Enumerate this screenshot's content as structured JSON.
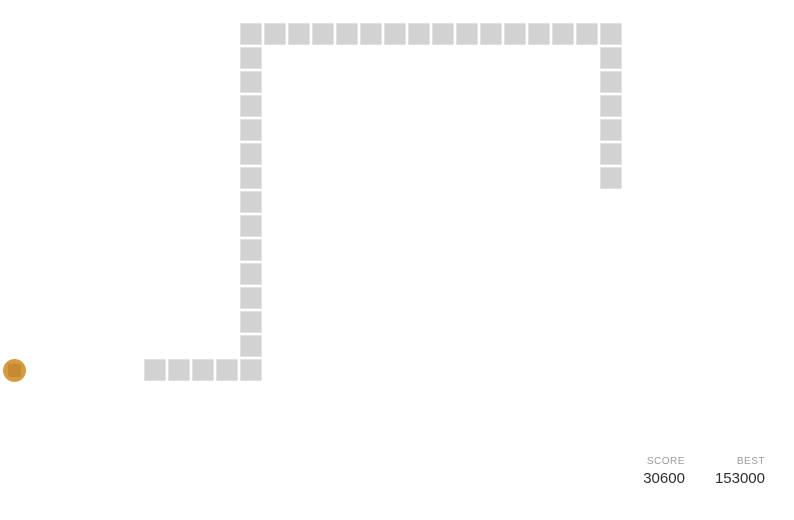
{
  "board": {
    "background": "#ffffff",
    "grid": {
      "cell_size": 24,
      "origin_x": -1,
      "origin_y": 22,
      "gap": 2
    },
    "snake": {
      "color": "#d2d2d2",
      "length": 40,
      "cells": [
        [
          6,
          14
        ],
        [
          7,
          14
        ],
        [
          8,
          14
        ],
        [
          9,
          14
        ],
        [
          10,
          14
        ],
        [
          10,
          13
        ],
        [
          10,
          12
        ],
        [
          10,
          11
        ],
        [
          10,
          10
        ],
        [
          10,
          9
        ],
        [
          10,
          8
        ],
        [
          10,
          7
        ],
        [
          10,
          6
        ],
        [
          10,
          5
        ],
        [
          10,
          4
        ],
        [
          10,
          3
        ],
        [
          10,
          2
        ],
        [
          10,
          1
        ],
        [
          10,
          0
        ],
        [
          11,
          0
        ],
        [
          12,
          0
        ],
        [
          13,
          0
        ],
        [
          14,
          0
        ],
        [
          15,
          0
        ],
        [
          16,
          0
        ],
        [
          17,
          0
        ],
        [
          18,
          0
        ],
        [
          19,
          0
        ],
        [
          20,
          0
        ],
        [
          21,
          0
        ],
        [
          22,
          0
        ],
        [
          23,
          0
        ],
        [
          24,
          0
        ],
        [
          25,
          0
        ],
        [
          25,
          1
        ],
        [
          25,
          2
        ],
        [
          25,
          3
        ],
        [
          25,
          4
        ],
        [
          25,
          5
        ],
        [
          25,
          6
        ]
      ]
    },
    "food": {
      "color": "#d59b41",
      "inner_color": "#c68b30",
      "cx": 14,
      "cy": 370,
      "diameter": 23
    }
  },
  "scoreboard": {
    "score": {
      "label": "SCORE",
      "value": "30600"
    },
    "best": {
      "label": "BEST",
      "value": "153000"
    },
    "label_color": "#9c9c9c",
    "value_color": "#2e2e2e"
  }
}
